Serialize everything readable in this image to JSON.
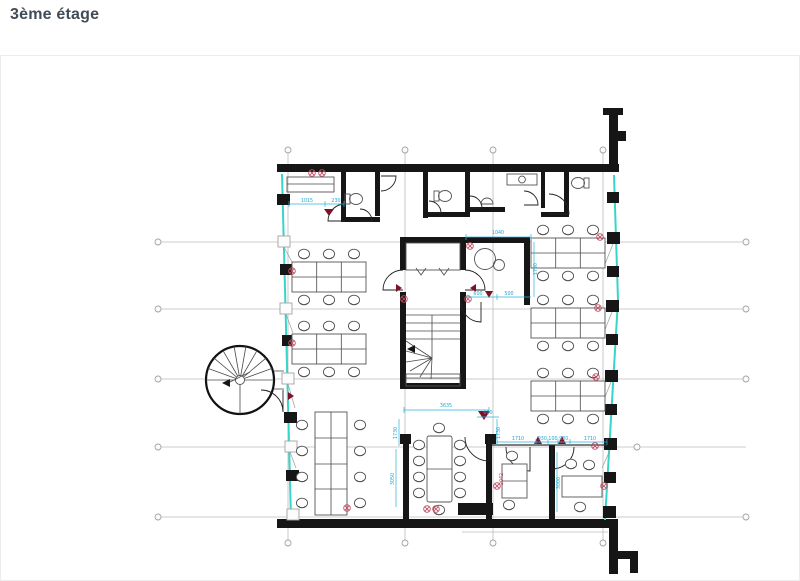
{
  "page": {
    "title": "3ème étage"
  },
  "plan": {
    "type": "architectural-floor-plan",
    "floor_label": "3ème étage",
    "colors": {
      "wall": "#161616",
      "glazing": "#38d4c9",
      "dimension_text": "#1ea8d2",
      "marker": "#c24e63",
      "door_marker": "#7d1128",
      "title_text": "#414b56"
    },
    "dimensions": [
      {
        "text": "1015",
        "x": 307,
        "y": 202
      },
      {
        "text": "230",
        "x": 336,
        "y": 202
      },
      {
        "text": "1040",
        "x": 498,
        "y": 234
      },
      {
        "text": "1730",
        "x": 537,
        "y": 269,
        "rot": -90
      },
      {
        "text": "600",
        "x": 478,
        "y": 295
      },
      {
        "text": "500",
        "x": 509,
        "y": 295
      },
      {
        "text": "3635",
        "x": 446,
        "y": 407
      },
      {
        "text": "600",
        "x": 488,
        "y": 414
      },
      {
        "text": "1730",
        "x": 397,
        "y": 433,
        "rot": -90
      },
      {
        "text": "3050",
        "x": 394,
        "y": 479,
        "rot": -90
      },
      {
        "text": "1730",
        "x": 500,
        "y": 433,
        "rot": -90
      },
      {
        "text": "3000",
        "x": 560,
        "y": 483,
        "rot": -90
      },
      {
        "text": "1710",
        "x": 518,
        "y": 440
      },
      {
        "text": "930 100 930",
        "x": 553,
        "y": 440
      },
      {
        "text": "1710",
        "x": 590,
        "y": 440
      },
      {
        "text": "2042",
        "x": 503,
        "y": 479,
        "rot": -90,
        "color": "red"
      }
    ]
  }
}
